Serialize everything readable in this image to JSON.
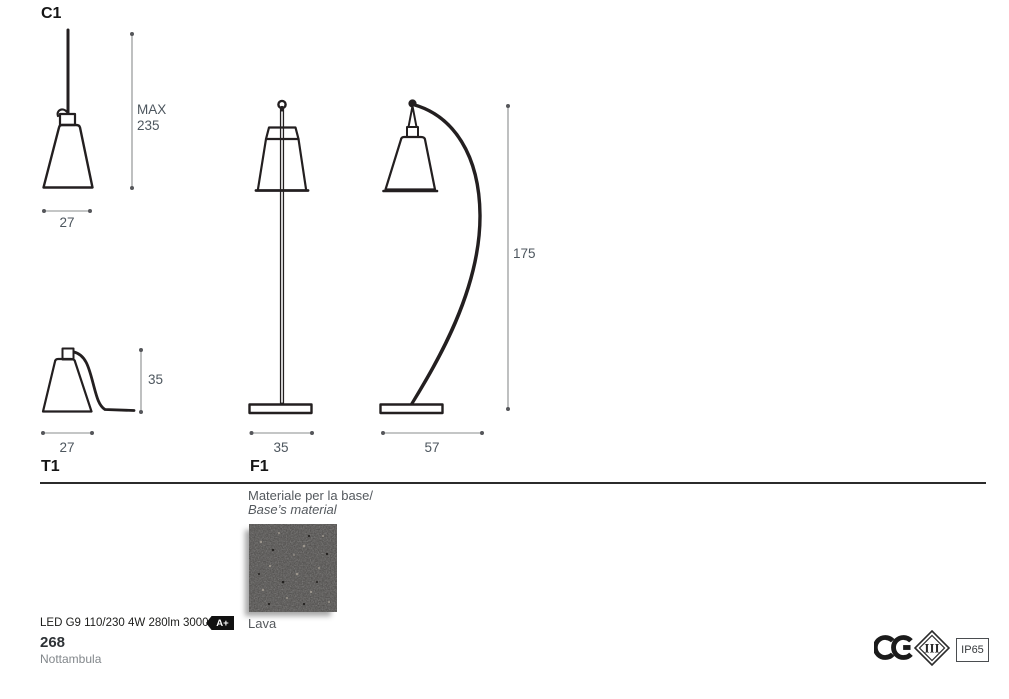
{
  "models": {
    "pendant": {
      "label": "C1",
      "height_max_label": "MAX",
      "height_max_value": "235",
      "width": "27"
    },
    "table": {
      "label": "T1",
      "height": "35",
      "width": "27"
    },
    "floor_straight": {
      "label": "F1",
      "base_width": "35"
    },
    "floor_arc": {
      "height": "175",
      "base_width": "57"
    }
  },
  "material": {
    "title_line1": "Materiale per la base/",
    "title_line2": "Base’s material",
    "swatch_name": "Lava"
  },
  "footer": {
    "led_spec": "LED G9 110/230 4W 280lm 3000°K",
    "energy_class": "A+",
    "page_number": "268",
    "product_name": "Nottambula"
  },
  "certifications": {
    "ce": "CE",
    "insulation_class": "III",
    "ip_rating": "IP65"
  },
  "colors": {
    "ink": "#231f20",
    "dim_line": "#8a8c8e",
    "dim_dot": "#55565a",
    "dim_text": "#4d565e",
    "swatch_base": "#4a4846"
  }
}
